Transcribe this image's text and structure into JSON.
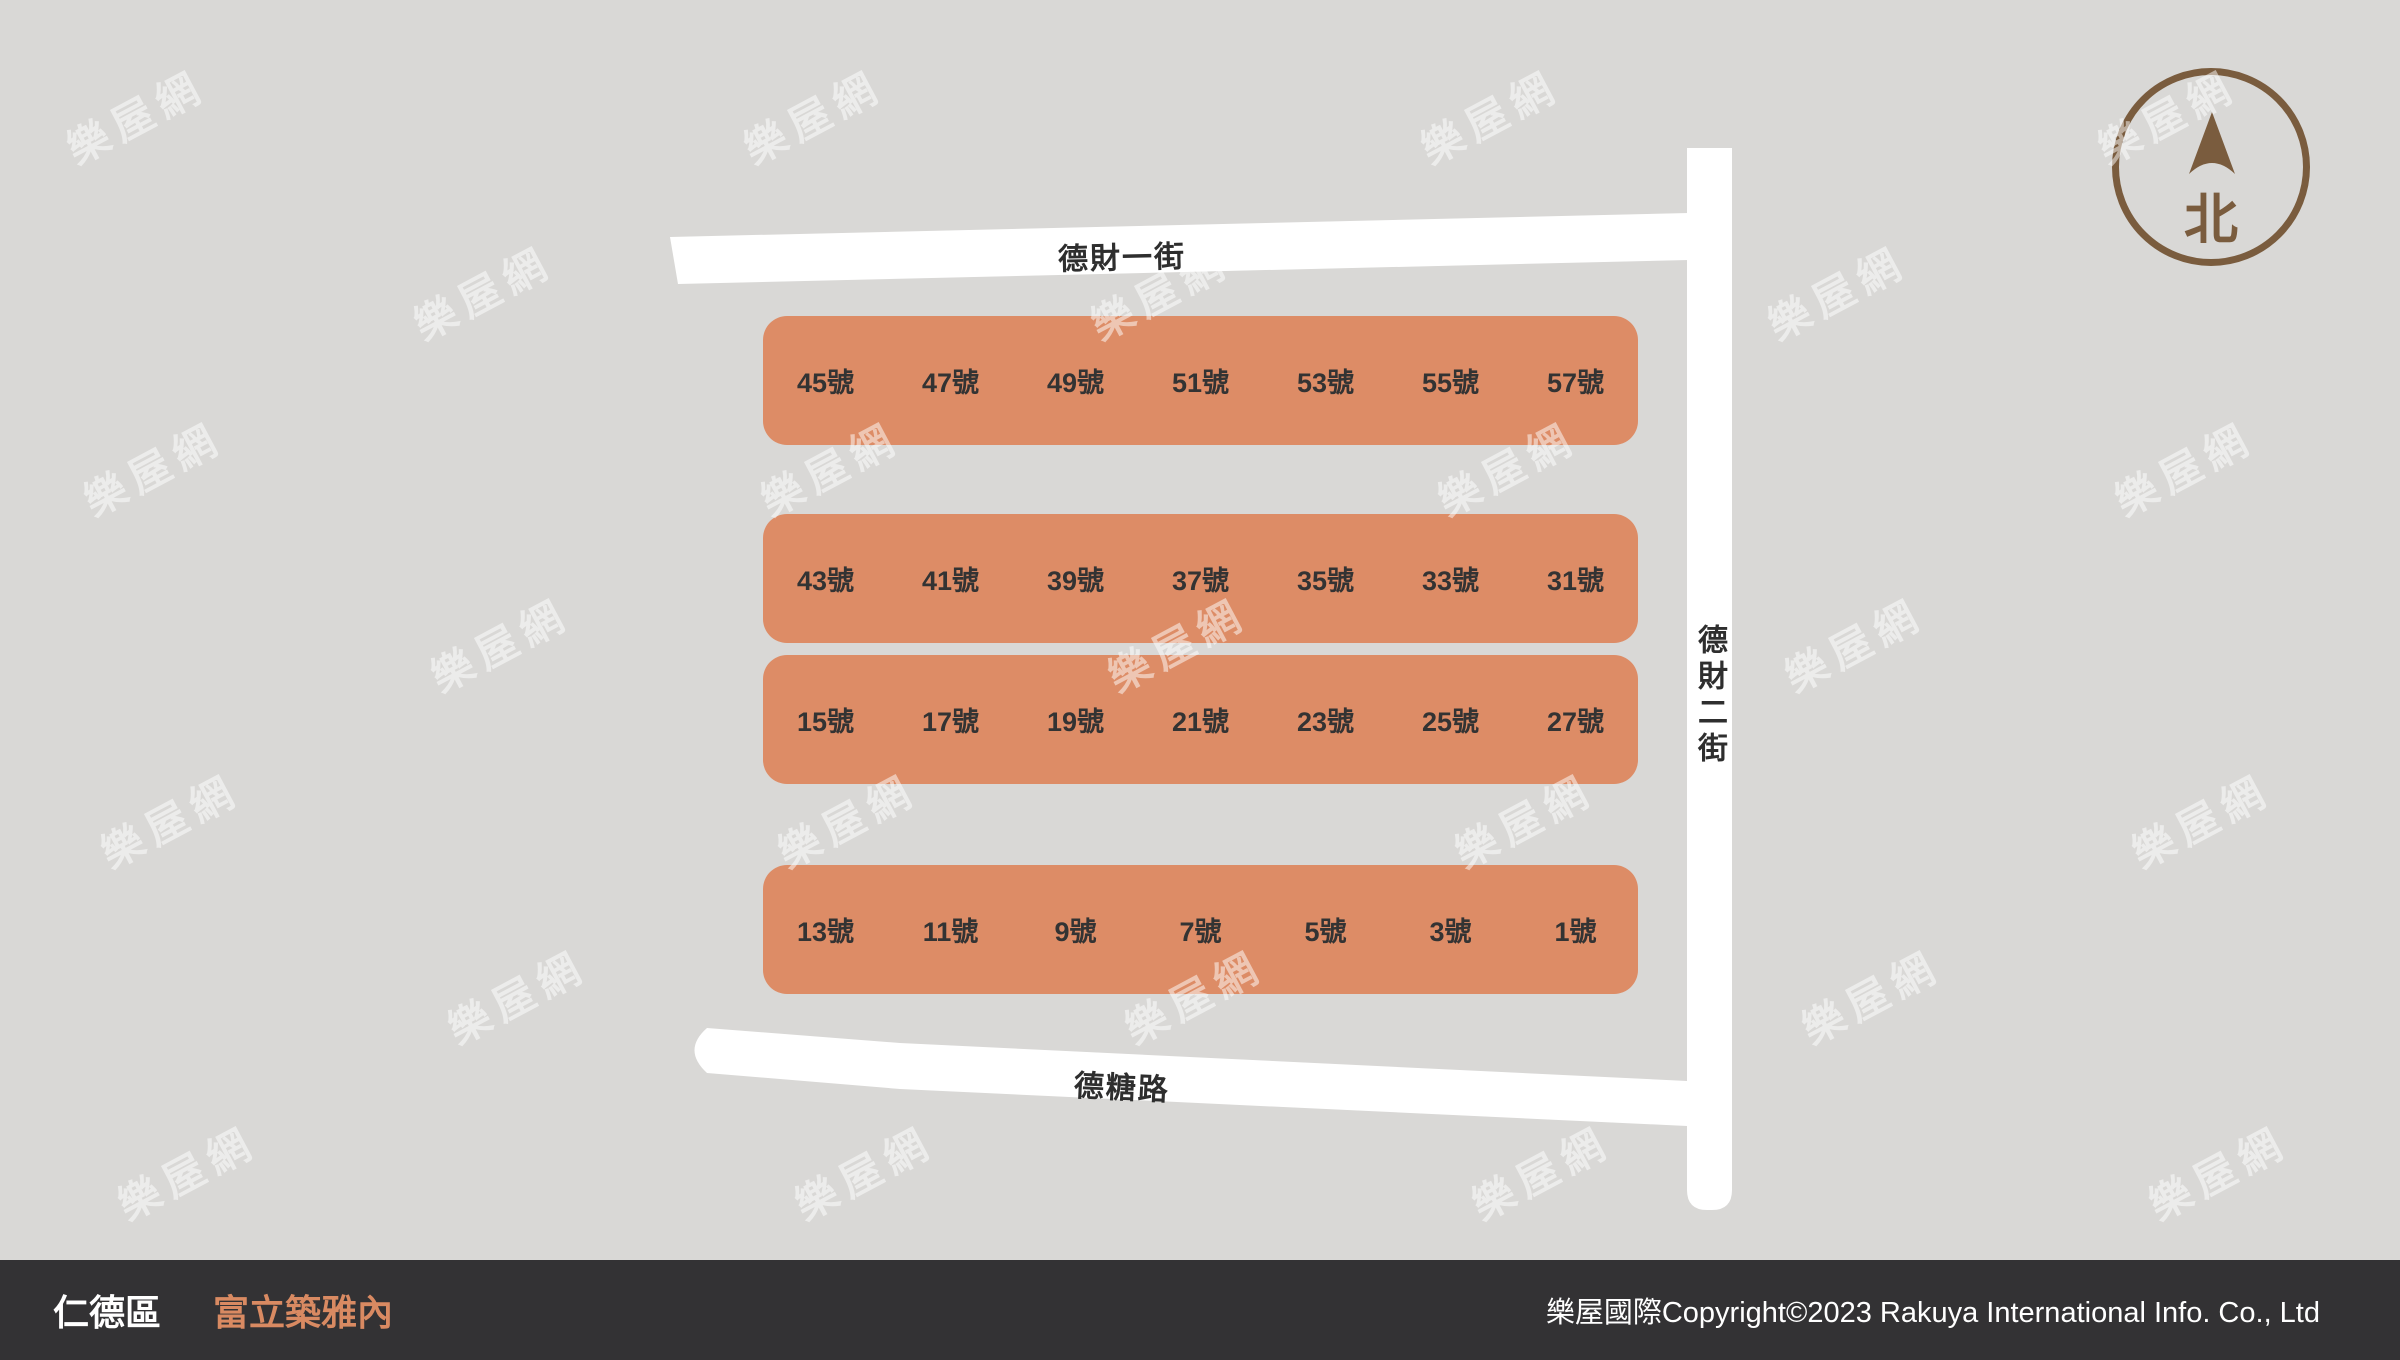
{
  "map": {
    "roads": {
      "top": {
        "label": "德財一街"
      },
      "right": {
        "label": "德財二街"
      },
      "bottom": {
        "label": "德糖路"
      }
    },
    "blocks": [
      {
        "units": [
          "45號",
          "47號",
          "49號",
          "51號",
          "53號",
          "55號",
          "57號"
        ]
      },
      {
        "units": [
          "43號",
          "41號",
          "39號",
          "37號",
          "35號",
          "33號",
          "31號"
        ]
      },
      {
        "units": [
          "15號",
          "17號",
          "19號",
          "21號",
          "23號",
          "25號",
          "27號"
        ]
      },
      {
        "units": [
          "13號",
          "11號",
          "9號",
          "7號",
          "5號",
          "3號",
          "1號"
        ]
      }
    ],
    "compass": {
      "label": "北"
    },
    "watermark": {
      "text": "樂屋網"
    }
  },
  "footer": {
    "district": "仁德區",
    "project": "富立築雅內",
    "copyright": "樂屋國際Copyright©2023 Rakuya International Info. Co., Ltd"
  },
  "colors": {
    "background": "#D9D8D6",
    "road": "#FFFFFF",
    "block": "#DD8C66",
    "block_text": "#333333",
    "road_text": "#2E2E2E",
    "compass": "#7A5C3E",
    "footer_bg": "#333234",
    "footer_text": "#FFFFFF",
    "project_text": "#D98A62",
    "watermark": "rgba(255,255,255,0.5)"
  }
}
